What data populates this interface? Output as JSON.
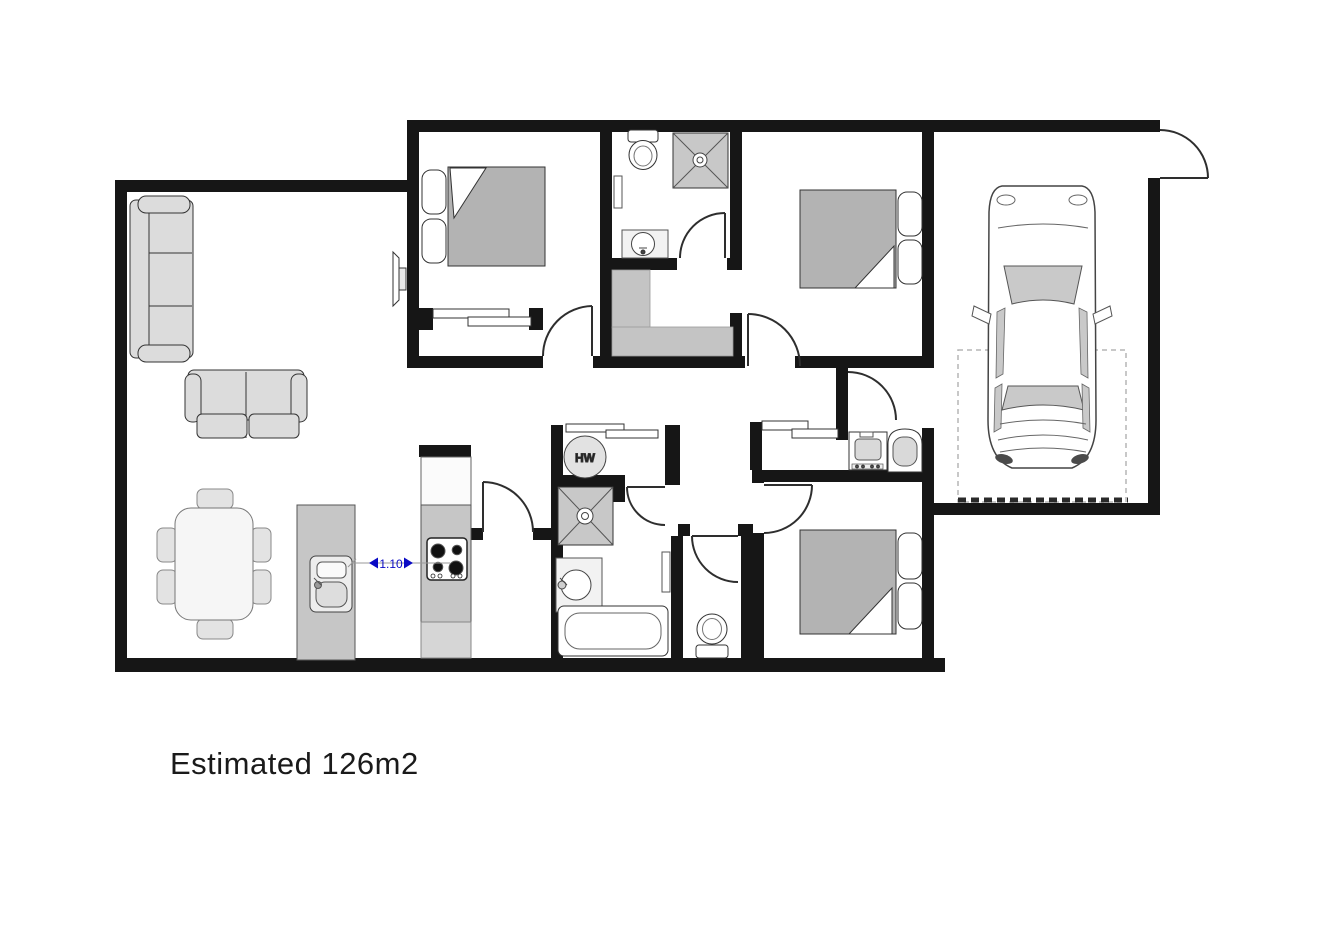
{
  "labels": {
    "area": "Estimated 126m2",
    "hot_water": "HW",
    "dimension": "1.10"
  },
  "colors": {
    "background": "#ffffff",
    "wall": "#161616",
    "door": "#2e2e2e",
    "outline": "#333333",
    "sofa_fill": "#dcdcdc",
    "table_fill": "#f6f6f6",
    "chair_fill": "#e3e3e3",
    "duvet_fill": "#b3b3b3",
    "fixture_gray": "#c8c8c8",
    "counter_gray": "#c6c6c6",
    "closet_gray": "#c4c4c4",
    "dimension_blue": "#0a0ac4",
    "text": "#1a1a1a"
  }
}
